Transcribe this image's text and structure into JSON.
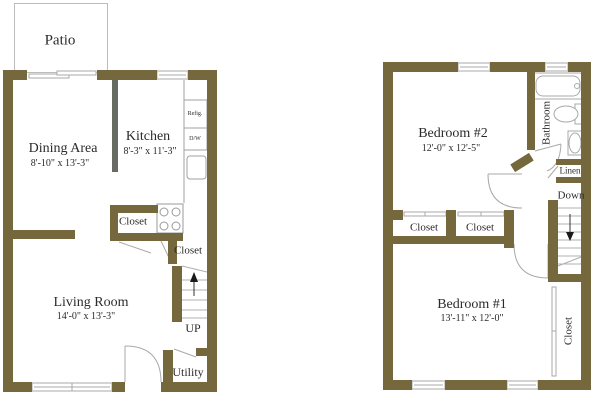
{
  "colors": {
    "wall": "#75683c",
    "kitchen_divider": "#686b64",
    "line": "#a9a9a9",
    "text": "#2b2b2b"
  },
  "floor1": {
    "patio_label": "Patio",
    "dining": {
      "name": "Dining Area",
      "dims": "8'-10\" x 13'-3\""
    },
    "kitchen": {
      "name": "Kitchen",
      "dims": "8'-3\" x 11'-3\""
    },
    "refrigerator_label": "Refig.",
    "dishwasher_label": "D/W",
    "closet_kitchen_label": "Closet",
    "closet_hall_label": "Closet",
    "living": {
      "name": "Living Room",
      "dims": "14'-0\" x 13'-3\""
    },
    "stairs_label": "UP",
    "utility_label": "Utility"
  },
  "floor2": {
    "bedroom2": {
      "name": "Bedroom #2",
      "dims": "12'-0\" x 12'-5\""
    },
    "bathroom_label": "Bathroom",
    "linen_label": "Linen",
    "stairs_label": "Down",
    "closet_left_label": "Closet",
    "closet_mid_label": "Closet",
    "bedroom1": {
      "name": "Bedroom #1",
      "dims": "13'-11\" x 12'-0\""
    },
    "closet_bedroom1_label": "Closet"
  }
}
